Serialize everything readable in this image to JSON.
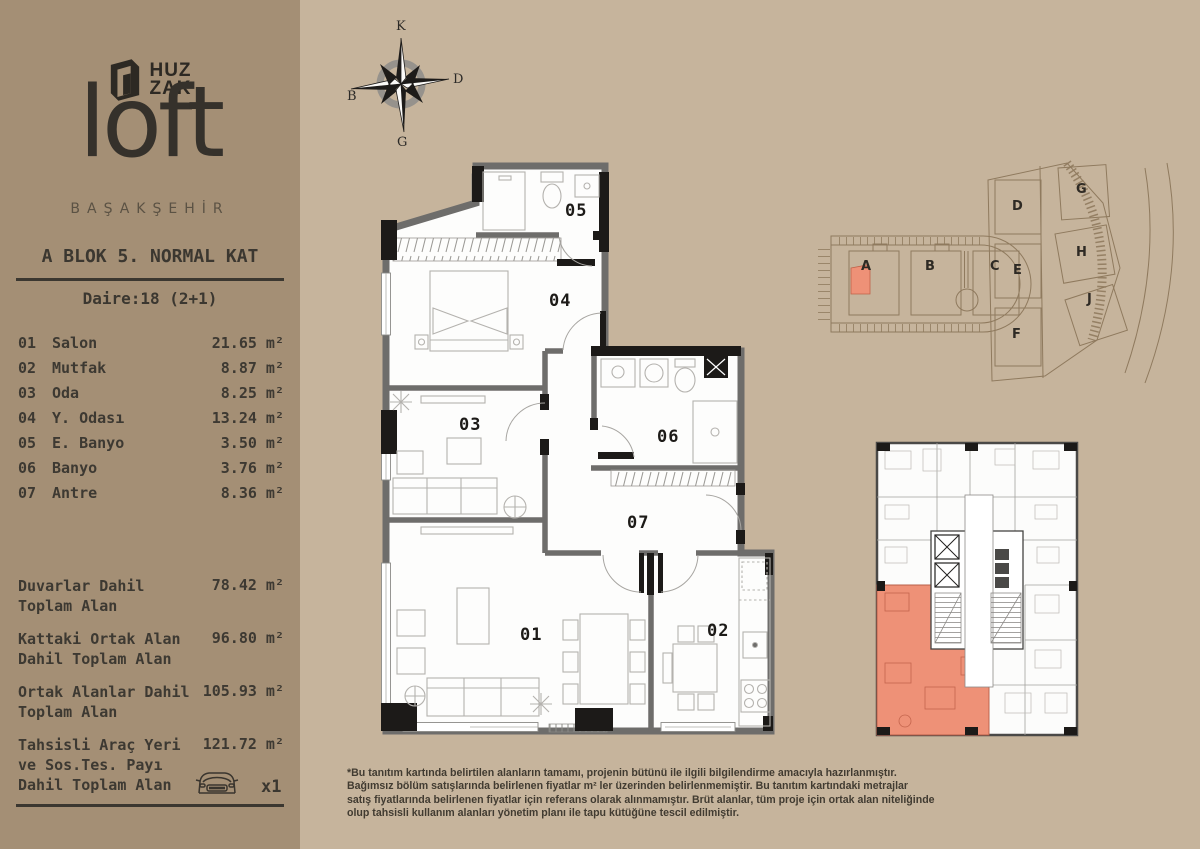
{
  "colors": {
    "background": "#c6b49c",
    "sidebar_background": "#a48f75",
    "text_dark": "#3b3730",
    "highlight_salmon": "#ee9177",
    "wall_gray": "#6e6d6b",
    "wall_black": "#1c1a18",
    "site_line_brown": "#8f7a5e"
  },
  "sidebar": {
    "brand": {
      "logo_icon": "door-logo-icon",
      "name_line1": "HUZ",
      "name_line2": "ZAK",
      "logo_word": "loft",
      "subtitle": "BAŞAKŞEHİR"
    },
    "header": {
      "block_title": "A BLOK 5. NORMAL KAT",
      "unit_title": "Daire:18 (2+1)"
    },
    "rooms": [
      {
        "no": "01",
        "name": "Salon",
        "area": "21.65 m²"
      },
      {
        "no": "02",
        "name": "Mutfak",
        "area": "8.87 m²"
      },
      {
        "no": "03",
        "name": "Oda",
        "area": "8.25 m²"
      },
      {
        "no": "04",
        "name": "Y. Odası",
        "area": "13.24 m²"
      },
      {
        "no": "05",
        "name": "E. Banyo",
        "area": "3.50 m²"
      },
      {
        "no": "06",
        "name": "Banyo",
        "area": "3.76 m²"
      },
      {
        "no": "07",
        "name": "Antre",
        "area": "8.36 m²"
      }
    ],
    "totals": [
      {
        "label": "Duvarlar Dahil Toplam Alan",
        "value": "78.42 m²"
      },
      {
        "label": "Kattaki Ortak Alan Dahil Toplam Alan",
        "value": "96.80 m²"
      },
      {
        "label": "Ortak Alanlar Dahil Toplam Alan",
        "value": "105.93 m²"
      },
      {
        "label": "Tahsisli Araç Yeri ve Sos.Tes. Payı Dahil Toplam Alan",
        "value": "121.72 m²"
      }
    ],
    "parking": {
      "icon": "car-front-icon",
      "count_label": "x1"
    }
  },
  "compass": {
    "north": "K",
    "east": "D",
    "south": "G",
    "west": "B"
  },
  "floor_plan": {
    "rooms": [
      "01",
      "02",
      "03",
      "04",
      "05",
      "06",
      "07"
    ]
  },
  "site_plan": {
    "blocks": [
      "A",
      "B",
      "C",
      "D",
      "E",
      "F",
      "G",
      "H",
      "J"
    ],
    "highlighted_block": "A"
  },
  "disclaimer": {
    "lines": [
      "*Bu tanıtım kartında belirtilen alanların tamamı, projenin bütünü ile ilgili bilgilendirme amacıyla hazırlanmıştır.",
      "Bağımsız bölüm satışlarında belirlenen fiyatlar m² ler üzerinden belirlenmemiştir. Bu tanıtım kartındaki metrajlar",
      "satış fiyatlarında belirlenen fiyatlar için referans olarak alınmamıştır. Brüt alanlar, tüm proje için ortak alan niteliğinde",
      "olup tahsisli kullanım alanları yönetim planı ile tapu kütüğüne tescil edilmiştir."
    ]
  }
}
